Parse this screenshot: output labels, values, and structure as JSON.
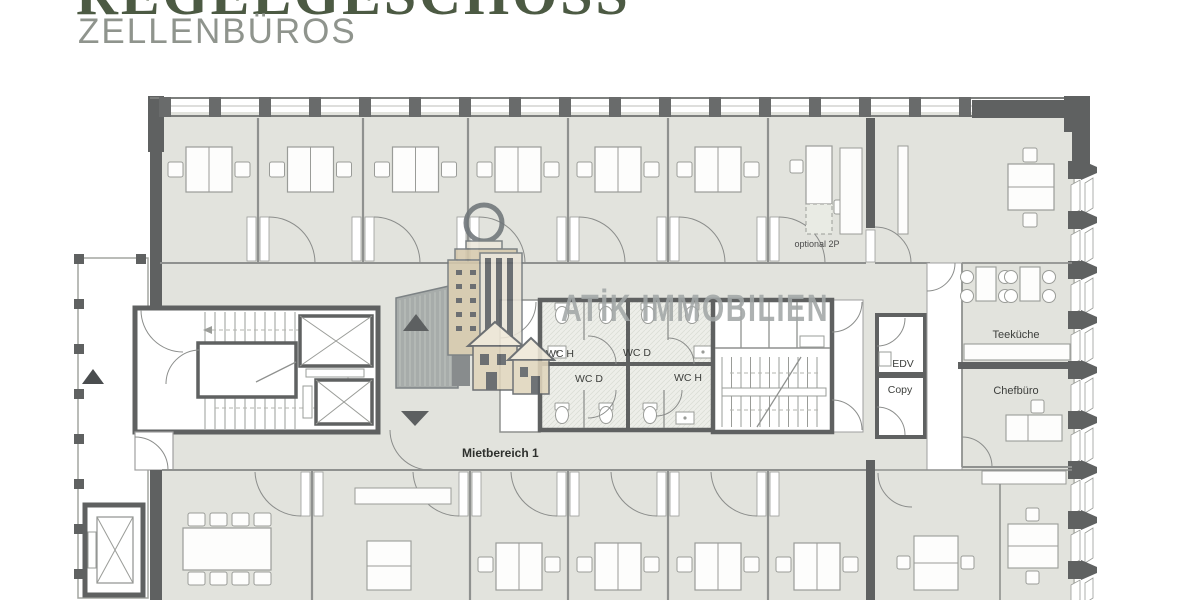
{
  "header": {
    "title": "REGELGESCHOSS",
    "subtitle": "ZELLENBÜROS"
  },
  "watermark": {
    "brand": "ATİK IMMOBILIEN"
  },
  "plan": {
    "labels": {
      "wc_h_top": "WC H",
      "wc_d_top": "WC D",
      "wc_d_bottom": "WC D",
      "wc_h_bottom": "WC H",
      "edv": "EDV",
      "copy": "Copy",
      "teekueche": "Teeküche",
      "chefbuero": "Chefbüro",
      "optional_2p": "optional 2P",
      "mietbereich": "Mietbereich 1"
    }
  },
  "colors": {
    "title_green": "#4c5a43",
    "subtitle_gray": "#8f948d",
    "room_fill": "#e2e3dd",
    "wall_dark": "#5f6161",
    "thin_wall": "#8f918f",
    "watermark_gray": "#a2a7a7",
    "logo_tan": "#d6c9ad"
  }
}
